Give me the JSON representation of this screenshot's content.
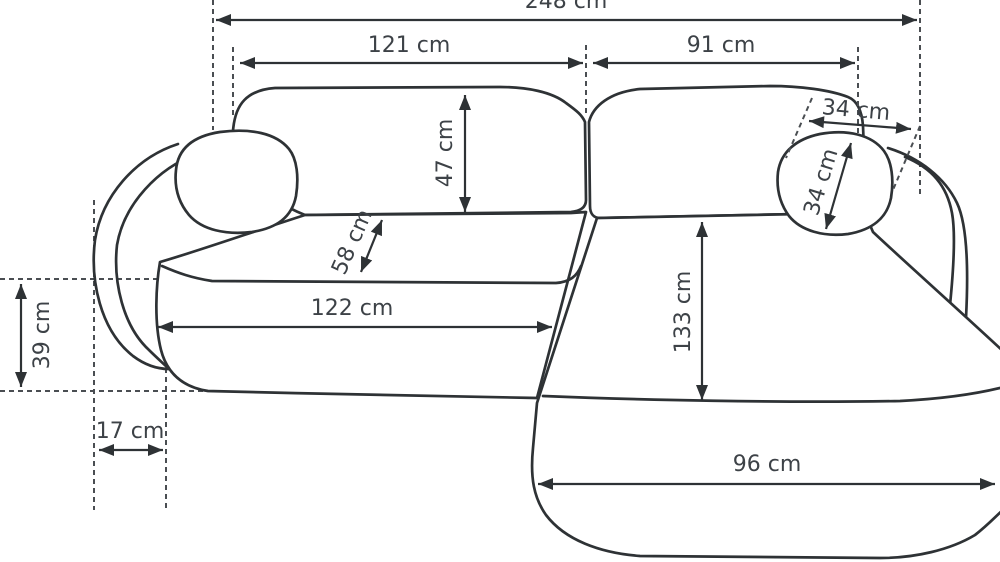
{
  "diagram": {
    "kind": "sofa-dimension-diagram",
    "view": "top-down line drawing of corner sofa with chaise",
    "unit": "cm",
    "colors": {
      "line": "#2e3235",
      "dashed_line": "#4a4e52",
      "text": "#3d4247",
      "background": "#ffffff"
    },
    "labels": {
      "overall_width": "248 cm",
      "left_seat_width": "121 cm",
      "chaise_section_width": "91 cm",
      "backrest_depth": "47 cm",
      "seat_back_depth": "58 cm",
      "headrest_pillow_width": "34 cm",
      "headrest_pillow_depth": "34 cm",
      "seat_cushion_width": "122 cm",
      "chaise_length": "133 cm",
      "armrest_side_depth": "39 cm",
      "armrest_width": "17 cm",
      "chaise_cushion_width": "96 cm"
    }
  }
}
